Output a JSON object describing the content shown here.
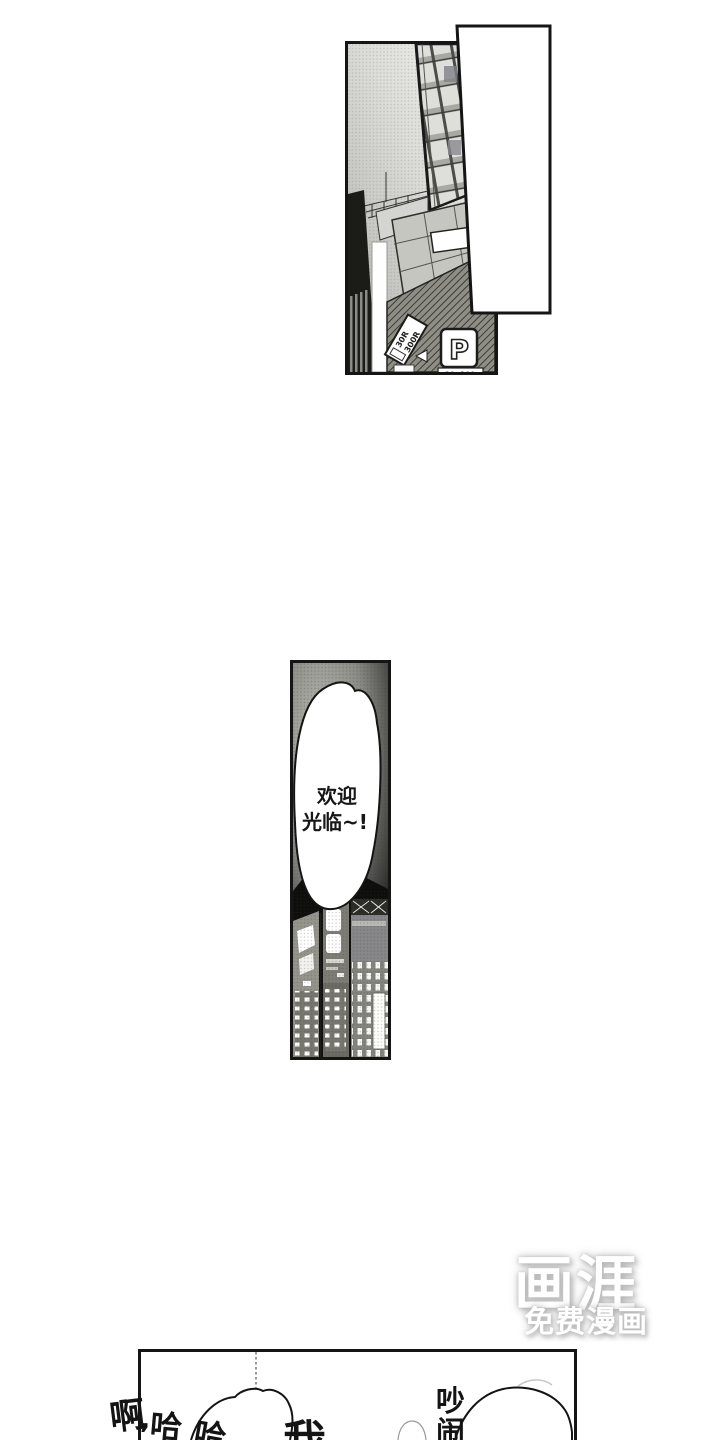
{
  "page": {
    "width": 720,
    "height": 1440,
    "background": "#ffffff"
  },
  "colors": {
    "panel_border": "#151515",
    "ink": "#141414",
    "watermark_text": "#ffffff",
    "watermark_shadow": "#bebebe"
  },
  "top_panel": {
    "scene": "night city street with office tower",
    "pole_sign": {
      "line1": "30R",
      "line2": "300R"
    },
    "parking_sign": {
      "letter": "P",
      "rate": "30..300"
    }
  },
  "middle_panel": {
    "scene": "dark city skyline with large speech bubble",
    "greeting": {
      "line1": "欢迎",
      "line2": "光临~!"
    }
  },
  "bottom_panel": {
    "laugh": {
      "c1": "啊",
      "comma": ",",
      "c2": "哈",
      "c3": "哈"
    },
    "shout_partial": "我",
    "noisy": {
      "c1": "吵",
      "c2": "闹"
    }
  },
  "watermark": {
    "logo": "画涯",
    "tagline": "免费漫画"
  }
}
